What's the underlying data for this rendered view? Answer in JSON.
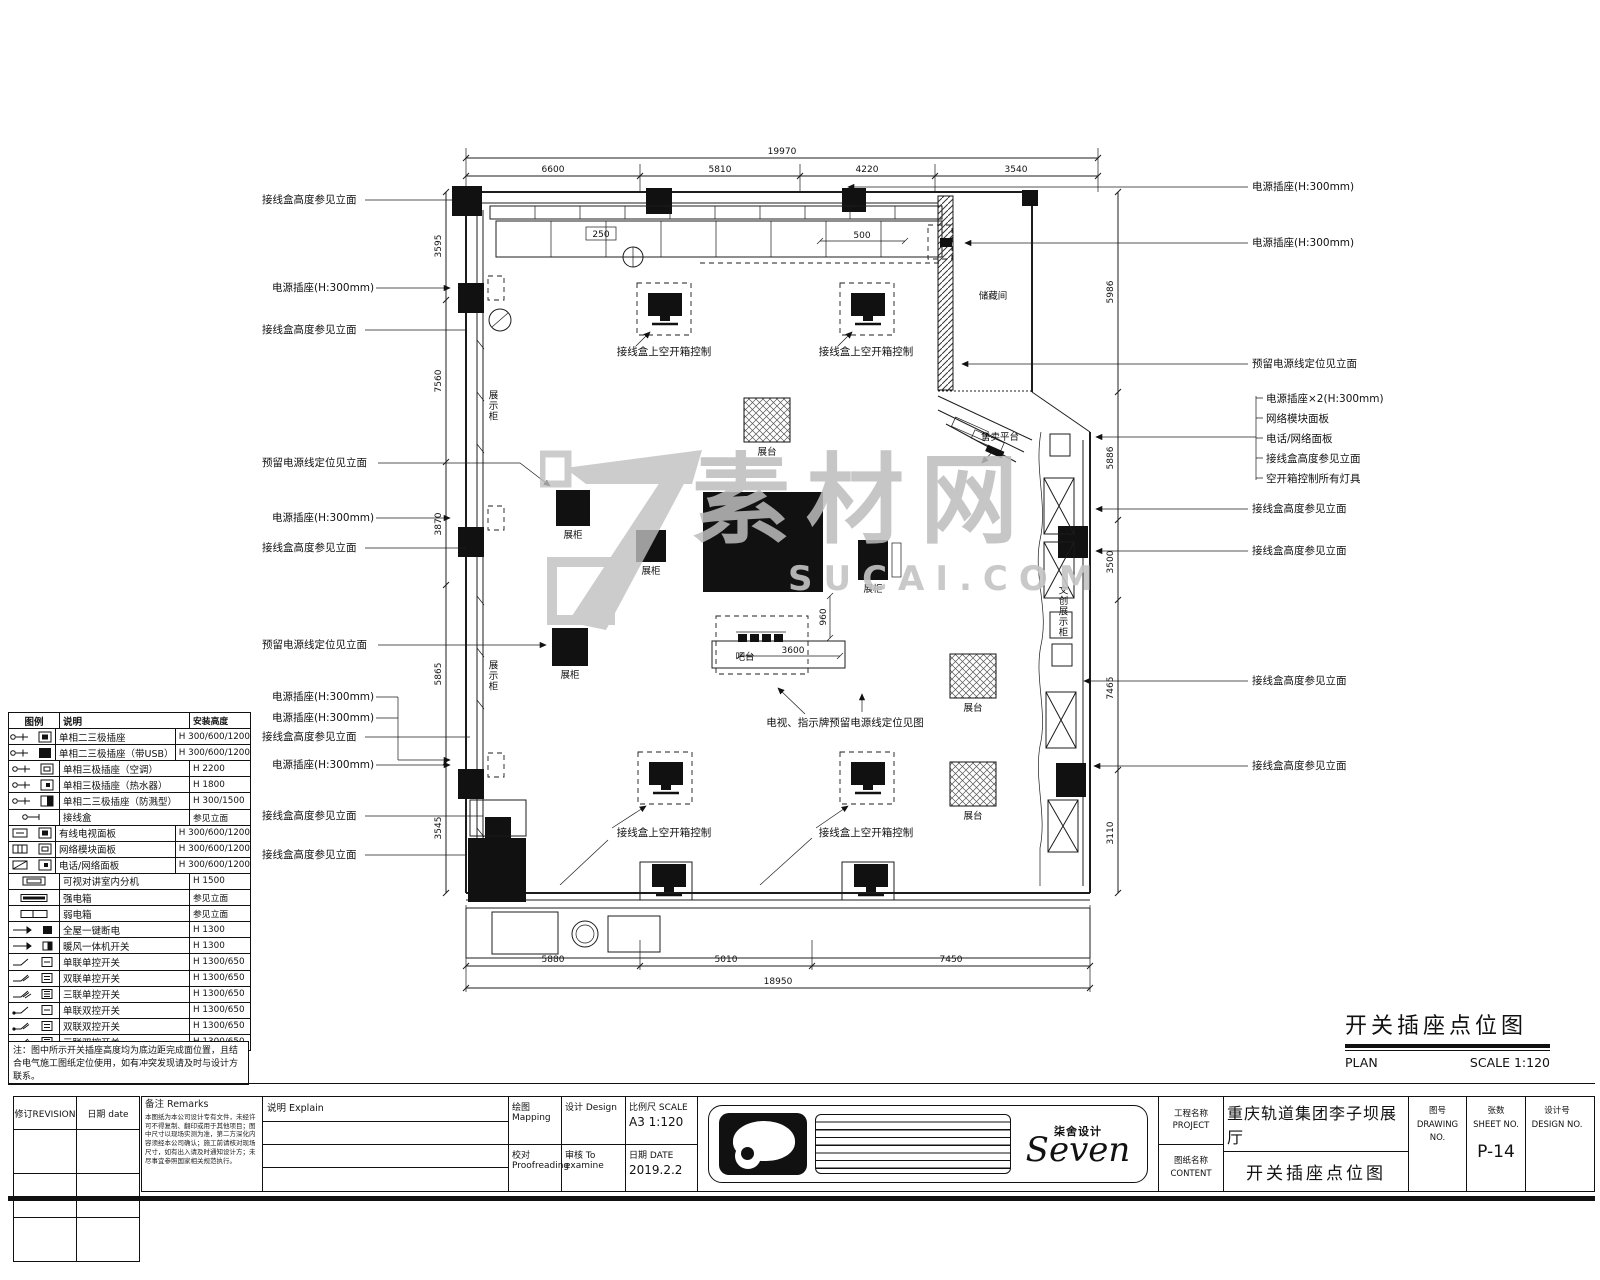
{
  "watermark": {
    "cn": "素材网",
    "en": "SUCAI.COM"
  },
  "drawing_title": {
    "title": "开关插座点位图",
    "plan": "PLAN",
    "scale": "SCALE 1:120"
  },
  "legend": {
    "headers": {
      "symbol": "图例",
      "desc": "说明",
      "height": "安装高度"
    },
    "rows": [
      {
        "icon": "#sk1",
        "desc": "单相二三极插座",
        "height": "H 300/600/1200"
      },
      {
        "icon": "#sk2",
        "desc": "单相二三极插座（带USB）",
        "height": "H 300/600/1200"
      },
      {
        "icon": "#sk3",
        "desc": "单相三极插座（空调）",
        "height": "H 2200"
      },
      {
        "icon": "#sk4",
        "desc": "单相三极插座（热水器）",
        "height": "H 1800"
      },
      {
        "icon": "#sk5",
        "desc": "单相二三极插座（防溅型）",
        "height": "H 300/1500"
      },
      {
        "icon": "#sk6",
        "desc": "接线盒",
        "height": "参见立面"
      },
      {
        "icon": "#sk7",
        "desc": "有线电视面板",
        "height": "H 300/600/1200"
      },
      {
        "icon": "#sk8",
        "desc": "网络模块面板",
        "height": "H 300/600/1200"
      },
      {
        "icon": "#sk9",
        "desc": "电话/网络面板",
        "height": "H 300/600/1200"
      },
      {
        "icon": "#sk10",
        "desc": "可视对讲室内分机",
        "height": "H 1500"
      },
      {
        "icon": "#sk11",
        "desc": "强电箱",
        "height": "参见立面"
      },
      {
        "icon": "#sk12",
        "desc": "弱电箱",
        "height": "参见立面"
      },
      {
        "icon": "#sk13",
        "desc": "全屋一键断电",
        "height": "H 1300"
      },
      {
        "icon": "#sk14",
        "desc": "暖风一体机开关",
        "height": "H 1300"
      },
      {
        "icon": "#sk15",
        "desc": "单联单控开关",
        "height": "H 1300/650"
      },
      {
        "icon": "#sk16",
        "desc": "双联单控开关",
        "height": "H 1300/650"
      },
      {
        "icon": "#sk17",
        "desc": "三联单控开关",
        "height": "H 1300/650"
      },
      {
        "icon": "#sk18",
        "desc": "单联双控开关",
        "height": "H 1300/650"
      },
      {
        "icon": "#sk19",
        "desc": "双联双控开关",
        "height": "H 1300/650"
      },
      {
        "icon": "#sk20",
        "desc": "三联双控开关",
        "height": "H 1300/650"
      }
    ],
    "note": "注：图中所示开关插座高度均为底边距完成面位置，且结合电气施工图纸定位使用，如有冲突发现请及时与设计方联系。"
  },
  "revision": {
    "rev_label": "修订REVISION",
    "date_label": "日期 date"
  },
  "title_block": {
    "remarks_label": "备注  Remarks",
    "remarks_text": "本图纸为本公司设计专有文件，未经许可不得复制、翻印或用于其他项目；图中尺寸以现场实测为准，第二方深化内容须经本公司确认；施工前请核对现场尺寸，如有出入请及时通知设计方；未尽事宜参照国家相关规范执行。",
    "explain_label": "说明  Explain",
    "mapping_label": "绘图 Mapping",
    "design_label": "设计 Design",
    "scale_label": "比例尺 SCALE",
    "scale_value": "A3 1:120",
    "proofread_label": "校对 Proofreading",
    "examine_label": "审核 To examine",
    "date_label": "日期 DATE",
    "date_value": "2019.2.2",
    "brand_cn": "柒舍设计",
    "brand_en": "Seven",
    "project_label": "工程名称",
    "project_label_en": "PROJECT",
    "project_value": "重庆轨道集团李子坝展厅",
    "content_label": "图纸名称",
    "content_label_en": "CONTENT",
    "content_value": "开关插座点位图",
    "drawing_no_label": "图号",
    "drawing_no_en": "DRAWING NO.",
    "sheet_no_label": "张数",
    "sheet_no_en": "SHEET NO.",
    "sheet_no_value": "P-14",
    "design_no_label": "设计号",
    "design_no_en": "DESIGN NO."
  },
  "plan": {
    "labels": {
      "storage": "储藏间",
      "sales": "售卖平台",
      "bar": "吧台",
      "stand": "展台",
      "case": "展柜",
      "display_cabinet": "展示柜",
      "cultural": "文创展示柜"
    },
    "ann": {
      "jbox": "接线盒高度参见立面",
      "socket300": "电源插座(H:300mm)",
      "socket300x2": "电源插座×2(H:300mm)",
      "reserve": "预留电源线定位见立面",
      "net": "网络模块面板",
      "phone": "电话/网络面板",
      "breaker": "空开箱控制所有灯具",
      "jbox_ctrl": "接线盒上空开箱控制",
      "tv": "电视、指示牌预留电源线定位见图"
    },
    "dims": {
      "top_total": "19970",
      "top": [
        "6600",
        "5810",
        "4220",
        "3540"
      ],
      "left": [
        "3595",
        "7560",
        "3870",
        "5865",
        "3545"
      ],
      "right": [
        "5986",
        "5886",
        "3500",
        "7465",
        "3110"
      ],
      "bottom": [
        "5880",
        "5010",
        "7450"
      ],
      "bottom_total": "18950",
      "d500": "500",
      "d250": "250",
      "d960": "960",
      "d3600": "3600"
    }
  }
}
